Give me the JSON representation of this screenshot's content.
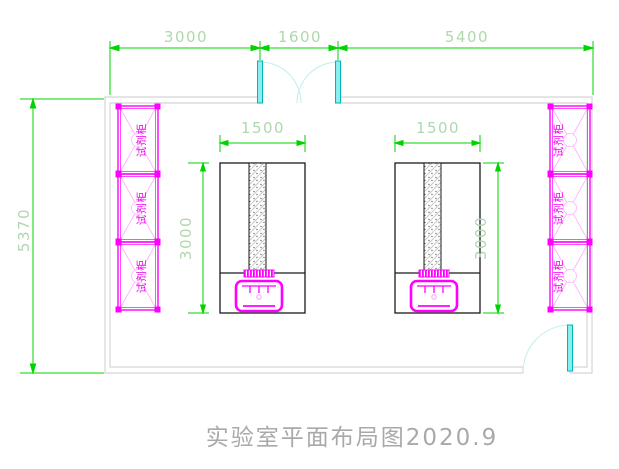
{
  "title": {
    "text": "实验室平面布局图2020.9"
  },
  "dimensions": {
    "top_segments": [
      {
        "label": "3000"
      },
      {
        "label": "1600"
      },
      {
        "label": "5400"
      }
    ],
    "left_total": {
      "label": "5370"
    },
    "bench_left": {
      "width_label": "1500",
      "depth_label": "3000"
    },
    "bench_right": {
      "width_label": "1500",
      "depth_label": "3000"
    }
  },
  "cabinets": {
    "left": [
      {
        "label": "试剂柜"
      },
      {
        "label": "试剂柜"
      },
      {
        "label": "试剂柜"
      }
    ],
    "right": [
      {
        "label": "试剂柜"
      },
      {
        "label": "试剂柜"
      },
      {
        "label": "试剂柜"
      }
    ]
  },
  "colors": {
    "dimension_line": "#00d400",
    "dimension_text": "#aed8ae",
    "cabinet_magenta": "#ff00ff",
    "cabinet_light": "#ff9aff",
    "door_leaf_cyan": "#00d8d8",
    "door_swing_arc": "#c2eeee",
    "wall_gray": "#d5d5d5",
    "bench_black": "#1a1a1a",
    "title_gray": "#a9a9a9"
  }
}
